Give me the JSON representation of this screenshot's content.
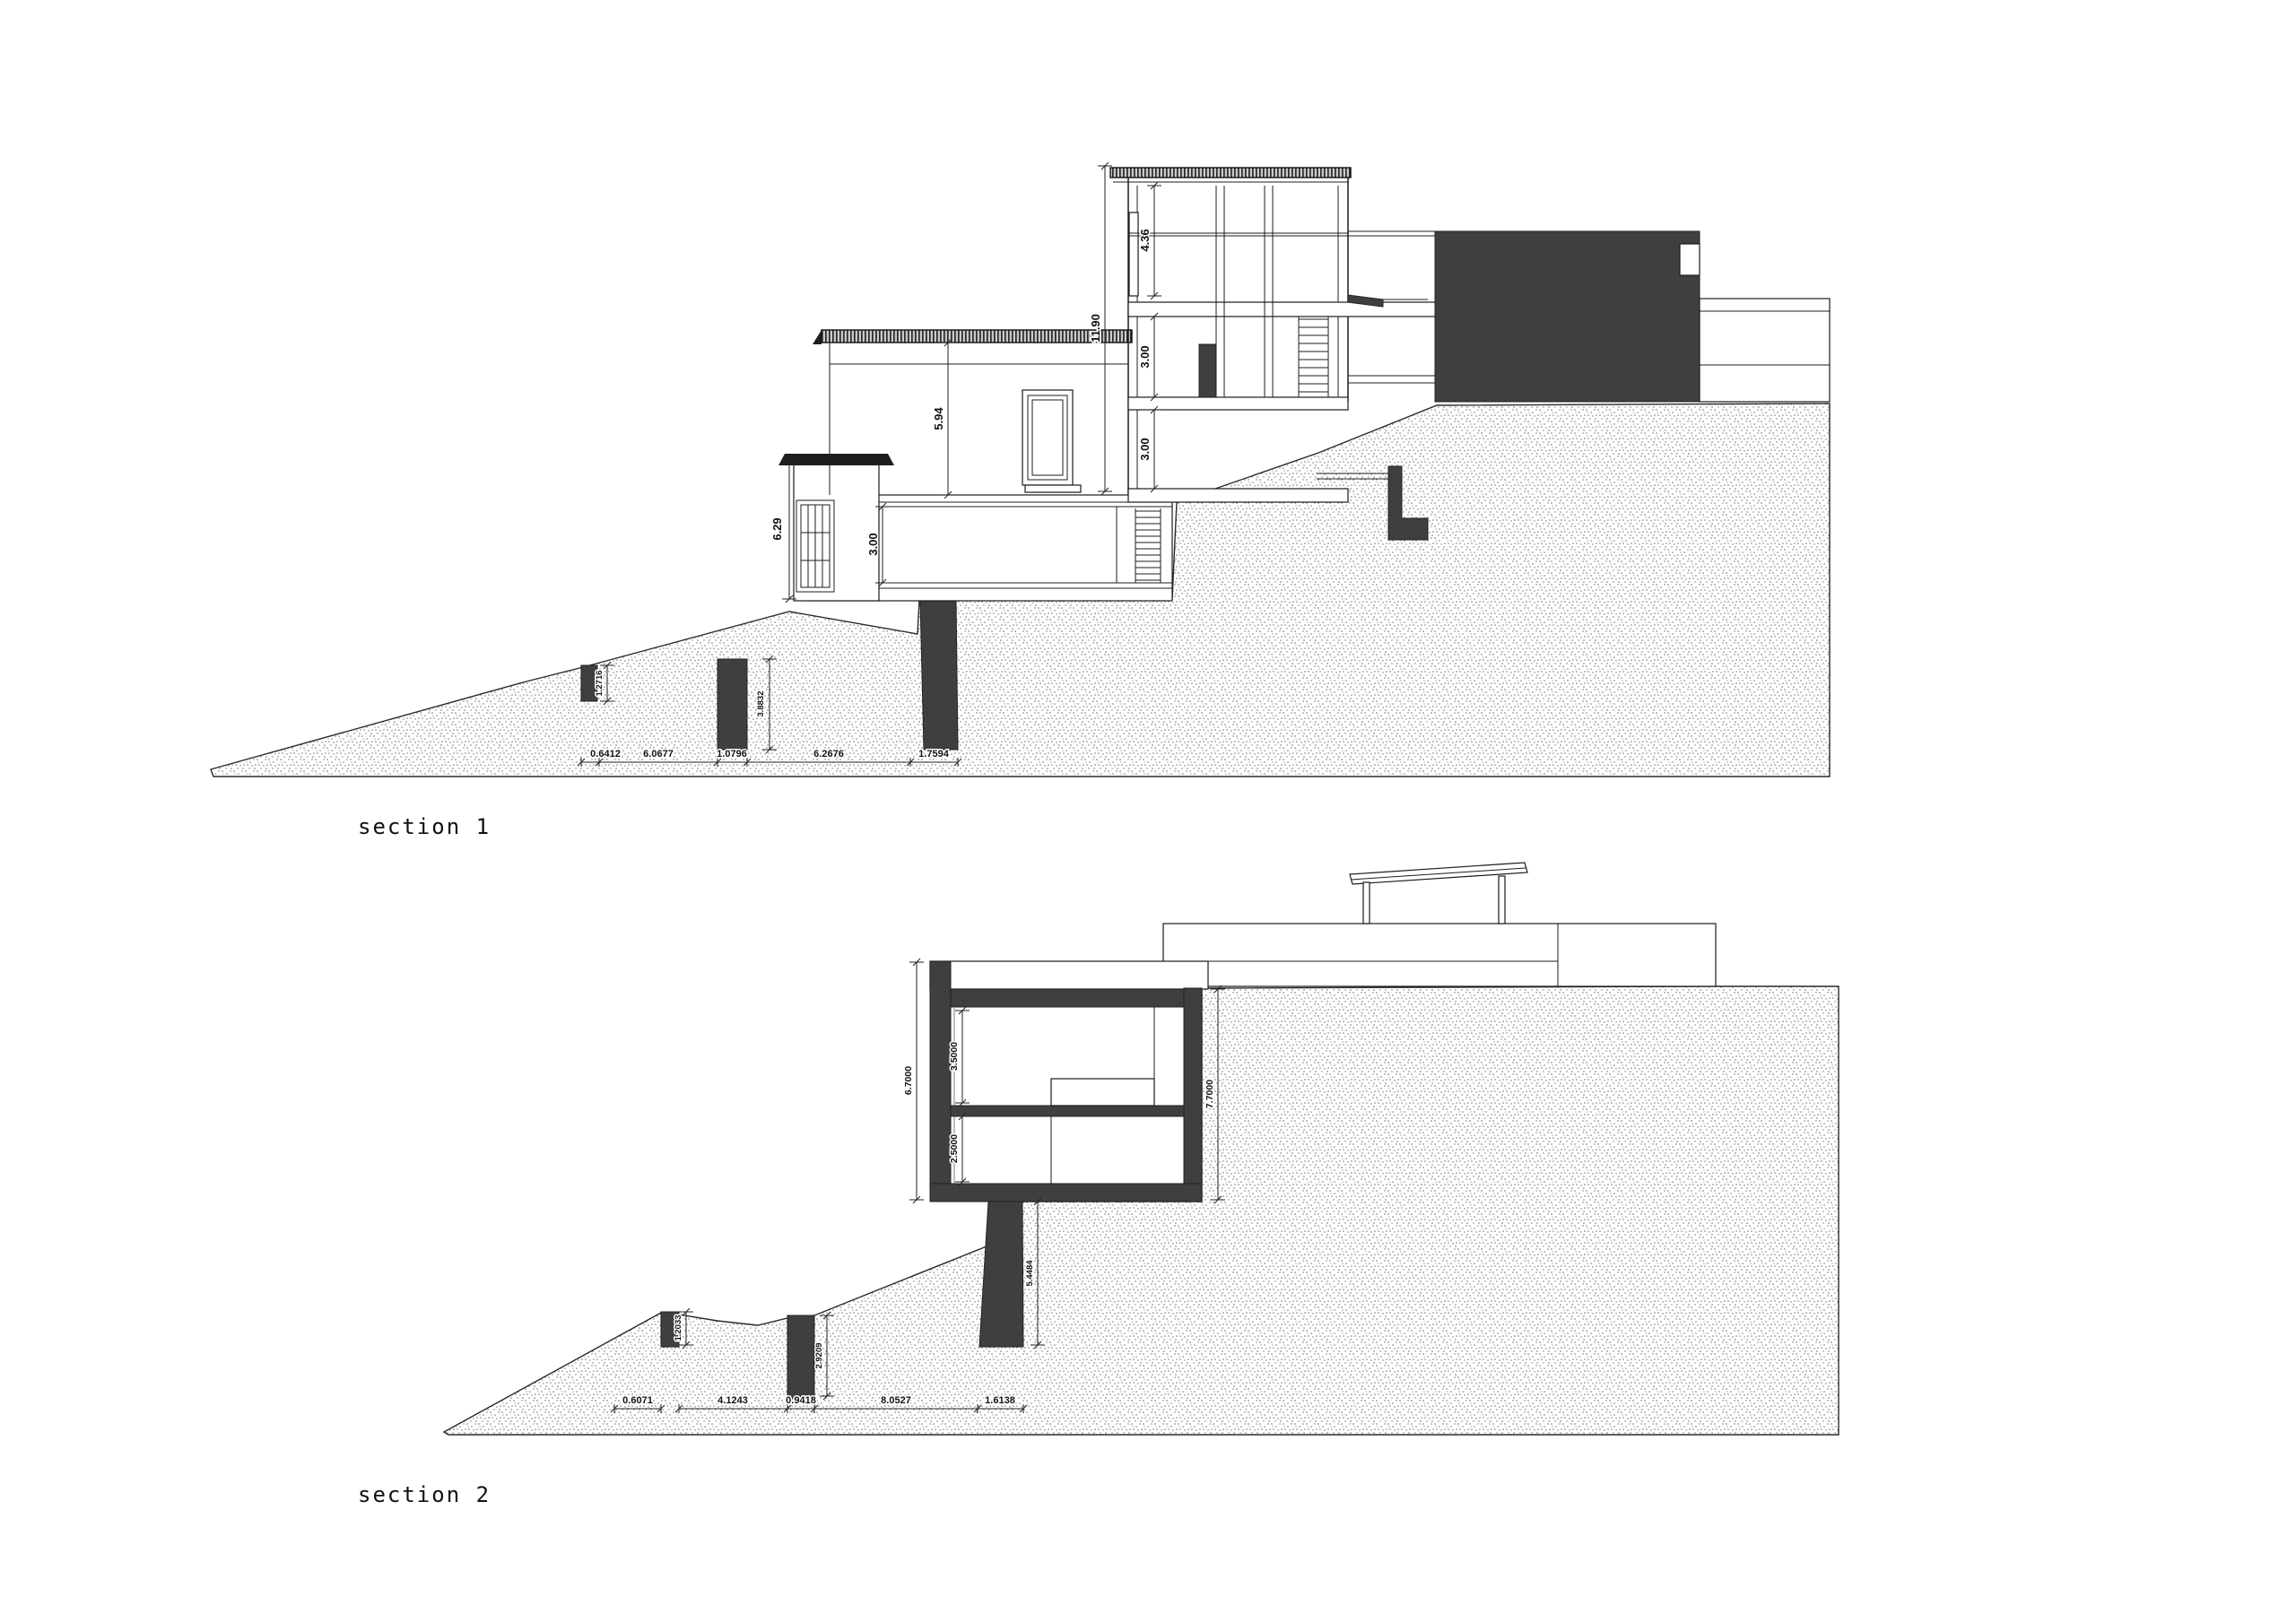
{
  "page": {
    "background": "#ffffff",
    "ink_color": "#1c1c1c",
    "solid_fill_color": "#3f3f3f"
  },
  "section1": {
    "title": "section 1",
    "vertical_dims": {
      "tower_overall_height": "11.90",
      "tower_top_floor": "4.36",
      "tower_mid_floor": "3.00",
      "tower_lower_floor": "3.00",
      "wing_height": "5.94",
      "basement_room_height": "3.00",
      "pavilion_height": "6.29",
      "post1_height": "1.2716",
      "post2_height": "3.8832"
    },
    "chain_dims": [
      "0.6412",
      "6.0677",
      "1.0796",
      "6.2676",
      "1.7594"
    ]
  },
  "section2": {
    "title": "section 2",
    "vertical_dims": {
      "left_overall_height": "6.7000",
      "upper_room_height": "3.5000",
      "lower_room_height": "2.5000",
      "right_overall_height": "7.7000",
      "pier_height": "5.4484",
      "wall1_height": "1.2033",
      "wall2_height": "2.9209"
    },
    "chain_dims": [
      "0.6071",
      "4.1243",
      "0.9418",
      "8.0527",
      "1.6138"
    ]
  }
}
